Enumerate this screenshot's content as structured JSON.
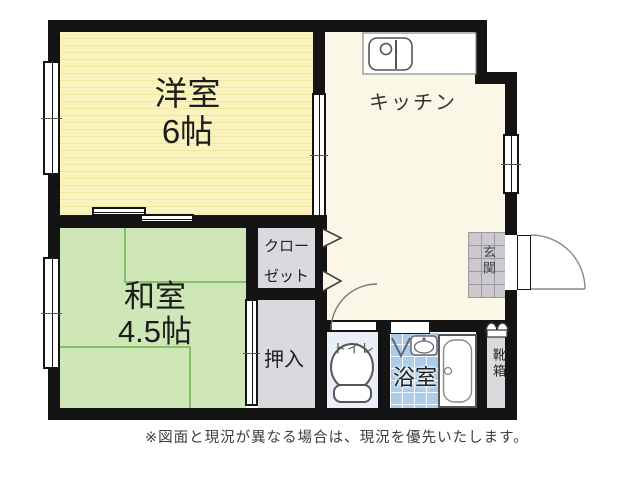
{
  "rooms": {
    "western": {
      "name": "洋室",
      "size": "6帖"
    },
    "kitchen": {
      "name": "キッチン"
    },
    "japanese": {
      "name": "和室",
      "size": "4.5帖"
    },
    "closet": {
      "line1": "クロー",
      "line2": "ゼット"
    },
    "oshiire": {
      "name": "押入"
    },
    "toilet": {
      "name": "トイレ"
    },
    "bath": {
      "name": "浴室"
    },
    "shoebox": {
      "name": "靴箱"
    },
    "entrance": {
      "name": "玄関"
    }
  },
  "disclaimer": "※図面と現況が異なる場合は、現況を優先いたします。",
  "colors": {
    "wall": "#141414",
    "western_room": "#faf3bd",
    "japanese_room": "#cfe6b6",
    "tatami_line": "#85c16c",
    "kitchen": "#faf7e6",
    "bath_tile": "#abcdec",
    "toilet_floor": "#e9eef7",
    "storage_gray": "#dbd8de",
    "entrance_tile": "#cbc9ce"
  }
}
